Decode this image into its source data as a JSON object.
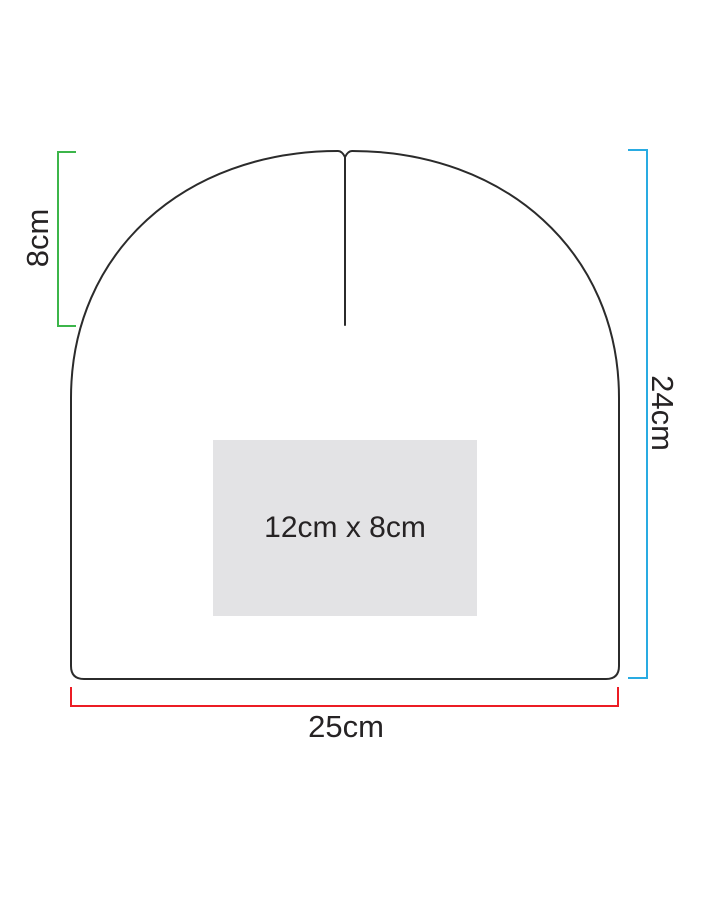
{
  "background": "#ffffff",
  "outline_color": "#2b2b2b",
  "measurements": {
    "crown_height": {
      "label": "8cm",
      "color": "#3cb54a"
    },
    "total_height": {
      "label": "24cm",
      "color": "#29abe2"
    },
    "width": {
      "label": "25cm",
      "color": "#ec1c24"
    }
  },
  "print_area": {
    "label": "12cm x 8cm",
    "fill": "#e3e3e5"
  }
}
